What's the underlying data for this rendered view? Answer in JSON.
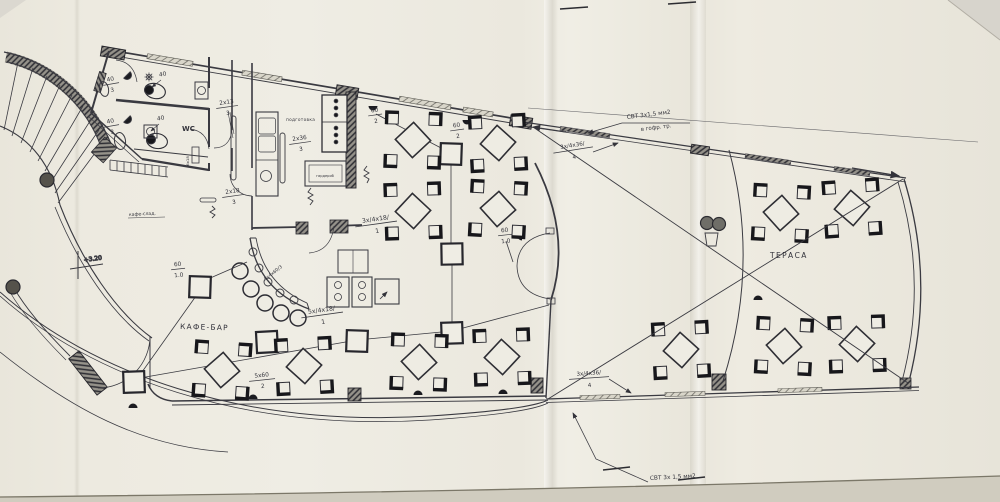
{
  "plan": {
    "cafe_bar": "КАФЕ-БАР",
    "terrace": "ТЕРАСА",
    "wc": "WC",
    "prep_room": "подготовка",
    "wardrobe_box": "гардероб",
    "cloak_note": "кафе-слад.",
    "level_mark": "+3.20"
  },
  "cables": {
    "top_line1": "СВТ 3х1,5 мм2",
    "top_line2": "в гофр. тр.",
    "bottom_line1": "СВТ 3х 1,5 мм2",
    "bottom_line2": "в гофр. тр."
  },
  "circuits": {
    "c36_top_num": "3х/4х36/",
    "c36_top_den": "4",
    "c36_bot_num": "3х/4х36/",
    "c36_bot_den": "4",
    "c18_dining_num": "3х/4х18/",
    "c18_dining_den": "1",
    "c18_bar_num": "5х/4х18/",
    "c18_bar_den": "1",
    "bar_arc_label": "5х4х60/3",
    "w60a_num": "60",
    "w60a_den": "2",
    "w60b_num": "60",
    "w60b_den": "2",
    "w60c_num": "60",
    "w60c_den": "1.0",
    "w60d_num": "60",
    "w60d_den": "1.0",
    "w5x60_num": "5х60",
    "w5x60_den": "2",
    "r2x13_num": "2х13",
    "r2x13_den": "3",
    "r2x18_num": "2х18",
    "r2x18_den": "3",
    "r2x36_num": "2х36",
    "r2x36_den": "3",
    "wc40a_num": "40",
    "wc40a_den": "3",
    "wc40b_num": "40",
    "wc40b_den": "3",
    "wc40c": "40",
    "wc40d": "40",
    "duct6x18": "6х18"
  }
}
